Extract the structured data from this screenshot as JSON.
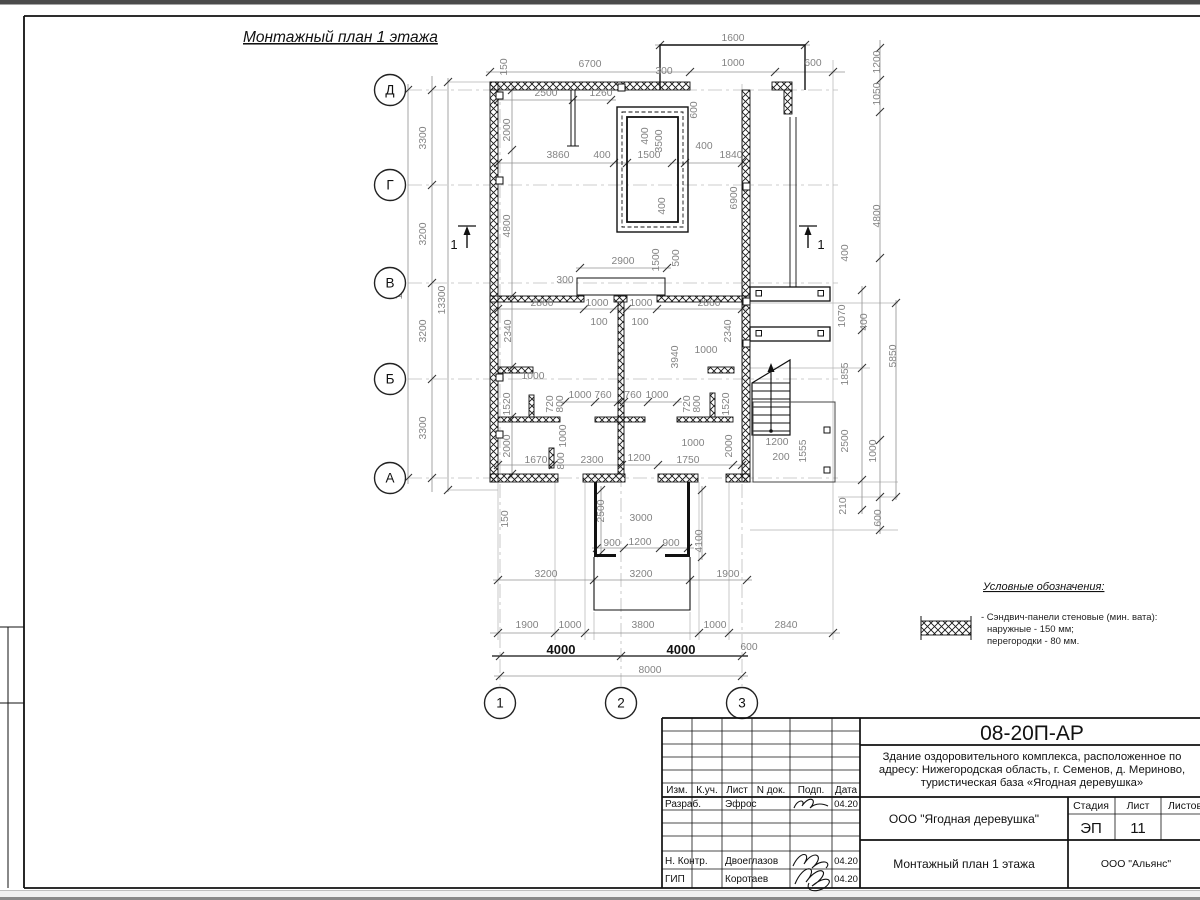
{
  "sheet": {
    "title": "Монтажный план 1 этажа"
  },
  "legend": {
    "title": "Условные обозначения:",
    "item": {
      "swatch": "crosshatch-wall-panel",
      "line1": "- Сэндвич-панели стеновые (мин. вата):",
      "line2": "наружные - 150 мм;",
      "line3": "перегородки - 80 мм."
    }
  },
  "title_block": {
    "doc_number": "08-20П-АР",
    "description": [
      "Здание оздоровительного комплекса, расположенное по",
      "адресу: Нижегородская область, г. Семенов, д. Мериново,",
      "туристическая база «Ягодная деревушка»"
    ],
    "columns": [
      "Изм.",
      "К.уч.",
      "Лист",
      "N док.",
      "Подп.",
      "Дата"
    ],
    "rows": [
      {
        "role": "Разраб.",
        "name": "Эфрос",
        "date": "04.20"
      },
      {
        "role": "Н. Контр.",
        "name": "Двоеглазов",
        "date": "04.20"
      },
      {
        "role": "ГИП",
        "name": "Коротаев",
        "date": "04.20"
      }
    ],
    "org": "ООО \"Ягодная деревушка\"",
    "sheet_title": "Монтажный план 1 этажа",
    "stage_label": "Стадия",
    "sheet_label": "Лист",
    "sheets_label": "Листов",
    "stage": "ЭП",
    "sheet_no": "11",
    "contractor": "ООО \"Альянс\""
  },
  "plan": {
    "axes": [
      {
        "l": "Д",
        "x": 390,
        "y": 90
      },
      {
        "l": "Г",
        "x": 390,
        "y": 185
      },
      {
        "l": "В",
        "x": 390,
        "y": 283
      },
      {
        "l": "Б",
        "x": 390,
        "y": 379
      },
      {
        "l": "А",
        "x": 390,
        "y": 478
      },
      {
        "l": "1",
        "x": 500,
        "y": 703
      },
      {
        "l": "2",
        "x": 621,
        "y": 703
      },
      {
        "l": "3",
        "x": 742,
        "y": 703
      }
    ],
    "section_marks": [
      {
        "l": "1",
        "x": 467,
        "y": 222,
        "s": -1
      },
      {
        "l": "1",
        "x": 808,
        "y": 222,
        "s": 1
      }
    ],
    "dims": [
      {
        "t": "1600",
        "x": 733,
        "y": 41
      },
      {
        "t": "6700",
        "x": 590,
        "y": 67
      },
      {
        "t": "1000",
        "x": 733,
        "y": 66
      },
      {
        "t": "600",
        "x": 813,
        "y": 66
      },
      {
        "t": "300",
        "x": 664,
        "y": 74
      },
      {
        "t": "150",
        "x": 507,
        "y": 67,
        "r": 1
      },
      {
        "t": "2500",
        "x": 546,
        "y": 96
      },
      {
        "t": "1260",
        "x": 601,
        "y": 96
      },
      {
        "t": "2000",
        "x": 510,
        "y": 130,
        "r": 1
      },
      {
        "t": "600",
        "x": 697,
        "y": 110,
        "r": 1
      },
      {
        "t": "3860",
        "x": 558,
        "y": 158
      },
      {
        "t": "400",
        "x": 602,
        "y": 158
      },
      {
        "t": "1500",
        "x": 649,
        "y": 158
      },
      {
        "t": "400",
        "x": 704,
        "y": 149
      },
      {
        "t": "1840",
        "x": 731,
        "y": 158
      },
      {
        "t": "400",
        "x": 648,
        "y": 136,
        "r": 1
      },
      {
        "t": "3500",
        "x": 662,
        "y": 141,
        "r": 1
      },
      {
        "t": "400",
        "x": 665,
        "y": 206,
        "r": 1
      },
      {
        "t": "6900",
        "x": 737,
        "y": 198,
        "r": 1
      },
      {
        "t": "4800",
        "x": 510,
        "y": 226,
        "r": 1
      },
      {
        "t": "1200",
        "x": 880,
        "y": 62,
        "r": 1
      },
      {
        "t": "1050",
        "x": 880,
        "y": 94,
        "r": 1
      },
      {
        "t": "4800",
        "x": 880,
        "y": 216,
        "r": 1
      },
      {
        "t": "400",
        "x": 848,
        "y": 253,
        "r": 1
      },
      {
        "t": "2900",
        "x": 623,
        "y": 264
      },
      {
        "t": "300",
        "x": 565,
        "y": 283
      },
      {
        "t": "1500",
        "x": 659,
        "y": 260,
        "r": 1
      },
      {
        "t": "500",
        "x": 679,
        "y": 258,
        "r": 1
      },
      {
        "t": "2860",
        "x": 542,
        "y": 306
      },
      {
        "t": "1000",
        "x": 597,
        "y": 306
      },
      {
        "t": "1000",
        "x": 641,
        "y": 306
      },
      {
        "t": "2860",
        "x": 709,
        "y": 306
      },
      {
        "t": "100",
        "x": 599,
        "y": 325
      },
      {
        "t": "100",
        "x": 640,
        "y": 325
      },
      {
        "t": "2340",
        "x": 511,
        "y": 331,
        "r": 1
      },
      {
        "t": "2340",
        "x": 731,
        "y": 331,
        "r": 1
      },
      {
        "t": "3940",
        "x": 678,
        "y": 357,
        "r": 1
      },
      {
        "t": "1000",
        "x": 706,
        "y": 353
      },
      {
        "t": "1000",
        "x": 533,
        "y": 379
      },
      {
        "t": "1070",
        "x": 845,
        "y": 316,
        "r": 1
      },
      {
        "t": "400",
        "x": 867,
        "y": 322,
        "r": 1
      },
      {
        "t": "5850",
        "x": 896,
        "y": 356,
        "r": 1
      },
      {
        "t": "1855",
        "x": 848,
        "y": 374,
        "r": 1
      },
      {
        "t": "1520",
        "x": 510,
        "y": 404,
        "r": 1
      },
      {
        "t": "720",
        "x": 553,
        "y": 404,
        "r": 1
      },
      {
        "t": "800",
        "x": 563,
        "y": 404,
        "r": 1
      },
      {
        "t": "1000",
        "x": 580,
        "y": 398
      },
      {
        "t": "760",
        "x": 603,
        "y": 398
      },
      {
        "t": "760",
        "x": 633,
        "y": 398
      },
      {
        "t": "1000",
        "x": 657,
        "y": 398
      },
      {
        "t": "720",
        "x": 690,
        "y": 404,
        "r": 1
      },
      {
        "t": "800",
        "x": 700,
        "y": 404,
        "r": 1
      },
      {
        "t": "1520",
        "x": 729,
        "y": 404,
        "r": 1
      },
      {
        "t": "2000",
        "x": 510,
        "y": 446,
        "r": 1
      },
      {
        "t": "1000",
        "x": 566,
        "y": 436,
        "r": 1
      },
      {
        "t": "800",
        "x": 564,
        "y": 461,
        "r": 1
      },
      {
        "t": "1670",
        "x": 536,
        "y": 463
      },
      {
        "t": "2300",
        "x": 592,
        "y": 463
      },
      {
        "t": "1200",
        "x": 639,
        "y": 461
      },
      {
        "t": "1750",
        "x": 688,
        "y": 463
      },
      {
        "t": "1000",
        "x": 693,
        "y": 446
      },
      {
        "t": "2000",
        "x": 732,
        "y": 446,
        "r": 1
      },
      {
        "t": "1200",
        "x": 777,
        "y": 445
      },
      {
        "t": "200",
        "x": 781,
        "y": 460
      },
      {
        "t": "1555",
        "x": 806,
        "y": 451,
        "r": 1
      },
      {
        "t": "2500",
        "x": 848,
        "y": 441,
        "r": 1
      },
      {
        "t": "1000",
        "x": 876,
        "y": 451,
        "r": 1
      },
      {
        "t": "210",
        "x": 846,
        "y": 506,
        "r": 1
      },
      {
        "t": "600",
        "x": 881,
        "y": 518,
        "r": 1
      },
      {
        "t": "150",
        "x": 508,
        "y": 519,
        "r": 1
      },
      {
        "t": "2500",
        "x": 604,
        "y": 511,
        "r": 1
      },
      {
        "t": "3000",
        "x": 641,
        "y": 521
      },
      {
        "t": "900",
        "x": 612,
        "y": 546
      },
      {
        "t": "1200",
        "x": 640,
        "y": 545
      },
      {
        "t": "900",
        "x": 671,
        "y": 546
      },
      {
        "t": "4100",
        "x": 702,
        "y": 541,
        "r": 1
      },
      {
        "t": "3200",
        "x": 546,
        "y": 577
      },
      {
        "t": "3200",
        "x": 641,
        "y": 577
      },
      {
        "t": "1900",
        "x": 728,
        "y": 577
      },
      {
        "t": "1900",
        "x": 527,
        "y": 628
      },
      {
        "t": "1000",
        "x": 570,
        "y": 628
      },
      {
        "t": "3800",
        "x": 643,
        "y": 628
      },
      {
        "t": "1000",
        "x": 715,
        "y": 628
      },
      {
        "t": "2840",
        "x": 786,
        "y": 628
      },
      {
        "t": "600",
        "x": 749,
        "y": 650
      },
      {
        "t": "4000",
        "x": 561,
        "y": 654,
        "c": 1,
        "fs": 13
      },
      {
        "t": "4000",
        "x": 681,
        "y": 654,
        "c": 1,
        "fs": 13
      },
      {
        "t": "8000",
        "x": 650,
        "y": 673
      },
      {
        "t": "13000",
        "x": 402,
        "y": 285,
        "r": 1
      },
      {
        "t": "3300",
        "x": 426,
        "y": 138,
        "r": 1
      },
      {
        "t": "3200",
        "x": 426,
        "y": 234,
        "r": 1
      },
      {
        "t": "3200",
        "x": 426,
        "y": 331,
        "r": 1
      },
      {
        "t": "3300",
        "x": 426,
        "y": 428,
        "r": 1
      },
      {
        "t": "13300",
        "x": 445,
        "y": 300,
        "r": 1
      }
    ]
  }
}
